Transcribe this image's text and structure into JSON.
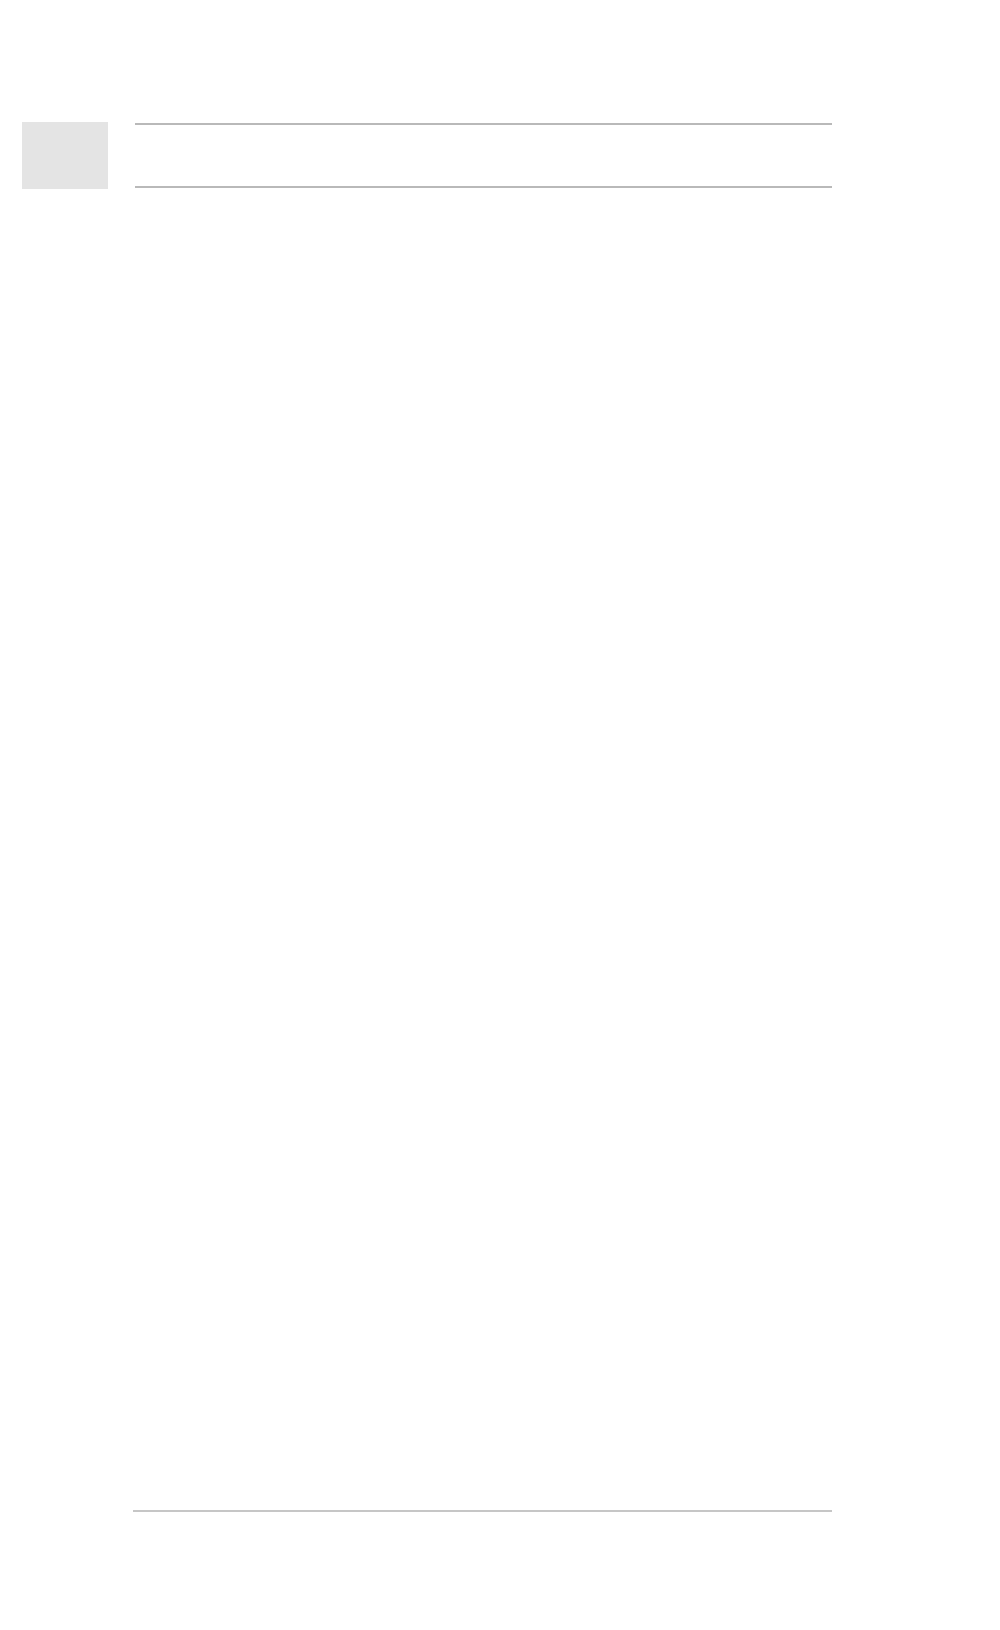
{
  "page": {
    "header": {
      "title": "新疆乌鲁木齐市米东区古牧地镇西工村安居富民小区"
    },
    "body": {
      "paragraph": "建筑造型采用现代主义的建筑风格，使用造价低廉的建筑材料（本地花岗岩、仿石漆等）。通过对比例、材料、细部等方面的推敲，形成大气、精致的建筑外观。建筑主体部分强调竖向线条，强调建筑物的高耸、挺拔，给人以拔地而起、傲然屹立的非凡气势。建筑色彩以简洁、明快的土黄、砖红为主色调，通过建筑细部的精心设计及强烈的虚实对比，使其成为一个城市空间的亮点和视觉焦点。同时考虑到了新疆冬季漫长的气候特点，使建筑能更好地适应并融入环境。"
    },
    "caption": {
      "award": "获奖情况：2016年获国际人居生态环境方案竞赛建筑和规划双金奖"
    }
  },
  "site_plan": {
    "road_label": "规划道路",
    "entrances": {
      "side": "行出入口",
      "community": "小区出入口",
      "kindergarten": "幼儿接送出入口",
      "garage_full": "地下车库出入口",
      "garage_short": "地下车库出入"
    },
    "areas": {
      "fire": "消防扑救场地",
      "kid_activity": "幼儿活动场地",
      "water_tank": "水箱间",
      "fire_pool": "地下消防水池",
      "market_line1": "标准化市场",
      "market_line2": "用地面积"
    },
    "buildings": [
      {
        "floors": "26F",
        "height": "H=77.500",
        "num": "1#"
      },
      {
        "floors": "26F",
        "height": "H=77.500",
        "num": "2#"
      },
      {
        "floors": "24F",
        "height": "H=71.700",
        "num": "3#"
      },
      {
        "floors": "24F",
        "height": "H=71.700",
        "num": "4#"
      },
      {
        "floors": "22F",
        "height": "H=65.900",
        "num": ""
      },
      {
        "floors": "22F",
        "height": "H=65.900",
        "num": "5#"
      },
      {
        "floors": "22F",
        "height": "H=65.900",
        "num": "6#"
      },
      {
        "floors": "24F",
        "height": "H=71.700",
        "num": "8#"
      },
      {
        "floors": "24F",
        "height": "H=71.700",
        "num": "9#"
      },
      {
        "floors": "26F",
        "height": "H=77.500",
        "num": "10#"
      },
      {
        "floors": "22F",
        "height": "H=65.900",
        "num": "11#"
      },
      {
        "floors": "26F",
        "height": "H=77.500",
        "num": "12#"
      }
    ],
    "facilities": {
      "kindergarten": {
        "f1": "1F",
        "f2": "2F",
        "name": "六班幼儿园",
        "height": "H=10.080"
      },
      "health": {
        "name": "卫生站",
        "height": "H=13.200"
      },
      "shop1": {
        "type": "商业",
        "floors": "3F",
        "name": "商-1#",
        "height": "H=13.200",
        "f2": "2F",
        "items": [
          "标准化市场",
          "对外公厕",
          "文化活动站"
        ]
      },
      "shop2": {
        "floors": "3F",
        "type": "商业",
        "name": "商-2#"
      },
      "mixed": {
        "line1": "1-3F为商业",
        "line2": "4-25F为住宅",
        "height": "H=79.100"
      },
      "shop3": {
        "name": "商-3#",
        "height": "H=13.200",
        "floors": "3F",
        "type": "商业"
      }
    },
    "dimensions": [
      "35.5m",
      "33.4m",
      "36.3m",
      "51.0m",
      "10.0m",
      "35.5m",
      "64.6m",
      "33.2m",
      "10.0m",
      "22.5m",
      "15",
      "12.0m",
      "10.0m",
      "54.4m",
      "10.0m",
      "43.1m",
      "47.0m",
      "12.0m",
      "54.0m",
      "19.2m",
      "54.5m",
      "14.7m",
      "12.0m",
      "12.0m",
      "10.0m",
      "10.0m",
      "21.1m",
      "33.4m",
      "20.3m",
      "15.0m"
    ]
  },
  "colors": {
    "accent_orange": "#ee8f2f",
    "water_blue": "#5b93d8",
    "green": "#a4ca70"
  }
}
